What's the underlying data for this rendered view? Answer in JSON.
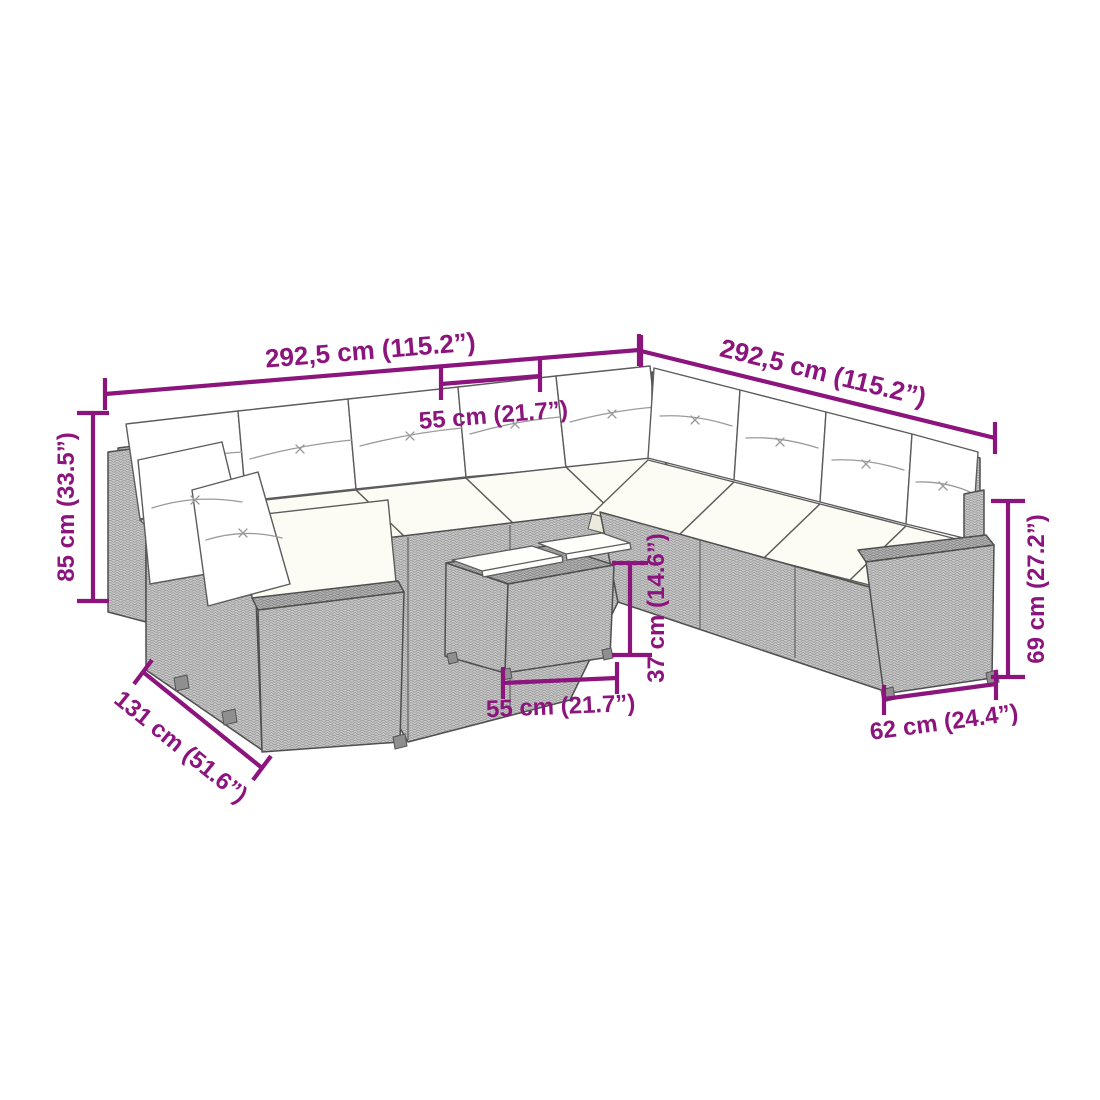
{
  "diagram": {
    "description": "L-shaped garden sofa set with back pillows, seat cushions and tray table, shown with measurement annotations",
    "accent_color": "#8b147d",
    "background_color": "#ffffff",
    "furniture_color": "#c7c7c7",
    "cushion_color": "#fdfcf4",
    "dims": {
      "left_total": "292,5 cm (115.2”)",
      "right_total": "292,5 cm (115.2”)",
      "seat_width": "55 cm (21.7”)",
      "back_height": "85 cm (33.5”)",
      "left_depth": "131 cm (51.6”)",
      "table_width": "55 cm (21.7”)",
      "table_height": "37 cm (14.6”)",
      "arm_height": "69 cm (27.2”)",
      "arm_depth": "62 cm (24.4”)"
    }
  }
}
